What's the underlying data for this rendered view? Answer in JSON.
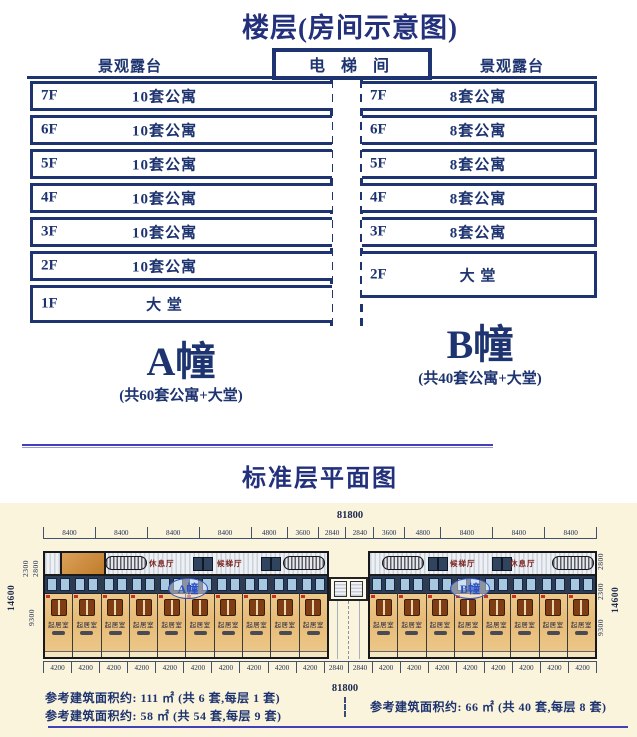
{
  "page": {
    "title_top": "楼层(房间示意图)",
    "title_plan": "标准层平面图"
  },
  "colors": {
    "navy": "#1e3470",
    "divider_blue": "#4242b6",
    "plan_cream": "#fbf4dc",
    "unit_tan": "#e7bb77",
    "badge_blue": "#2a50c4",
    "hall_maroon": "#7c2420",
    "accent_red": "#c23326"
  },
  "floor_diagram": {
    "terrace_left": "景观露台",
    "terrace_right": "景观露台",
    "elevator_label": "电 梯 间",
    "building_a": {
      "name": "A幢",
      "subtitle": "(共60套公寓+大堂)",
      "rows": [
        {
          "floor": "7F",
          "label": "10套公寓"
        },
        {
          "floor": "6F",
          "label": "10套公寓"
        },
        {
          "floor": "5F",
          "label": "10套公寓"
        },
        {
          "floor": "4F",
          "label": "10套公寓"
        },
        {
          "floor": "3F",
          "label": "10套公寓"
        },
        {
          "floor": "2F",
          "label": "10套公寓"
        },
        {
          "floor": "1F",
          "label": "大 堂"
        }
      ]
    },
    "building_b": {
      "name": "B幢",
      "subtitle": "(共40套公寓+大堂)",
      "rows": [
        {
          "floor": "7F",
          "label": "8套公寓"
        },
        {
          "floor": "6F",
          "label": "8套公寓"
        },
        {
          "floor": "5F",
          "label": "8套公寓"
        },
        {
          "floor": "4F",
          "label": "8套公寓"
        },
        {
          "floor": "3F",
          "label": "8套公寓"
        },
        {
          "floor": "2F",
          "label": "大 堂"
        }
      ]
    }
  },
  "floor_plan": {
    "total_dim_top": "81800",
    "total_dim_bottom": "81800",
    "top_dims": [
      "8400",
      "8400",
      "8400",
      "8400",
      "4800",
      "3600",
      "2840",
      "2840",
      "3600",
      "4800",
      "8400",
      "8400",
      "8400"
    ],
    "bottom_dims": [
      "4200",
      "4200",
      "4200",
      "4200",
      "4200",
      "4200",
      "4200",
      "4200",
      "4200",
      "4200",
      "2840",
      "2840",
      "4200",
      "4200",
      "4200",
      "4200",
      "4200",
      "4200",
      "4200",
      "4200"
    ],
    "left_dims": [
      "2300",
      "2800",
      "9300",
      "14600"
    ],
    "right_dims": [
      "2800",
      "2300",
      "9300",
      "14600"
    ],
    "wing_a": {
      "badge": "A幢",
      "rest_hall": "休息厅",
      "elevator_hall": "候梯厅",
      "unit_label": "起居室",
      "unit_count": 10
    },
    "wing_b": {
      "badge": "B幢",
      "rest_hall": "休息厅",
      "elevator_hall": "候梯厅",
      "unit_label": "起居室",
      "unit_count": 8
    },
    "notes": [
      "参考建筑面积约: 111 ㎡ (共 6 套,每层 1 套)",
      "参考建筑面积约: 58 ㎡ (共 54 套,每层 9 套)",
      "参考建筑面积约: 66 ㎡ (共 40 套,每层 8 套)"
    ]
  }
}
